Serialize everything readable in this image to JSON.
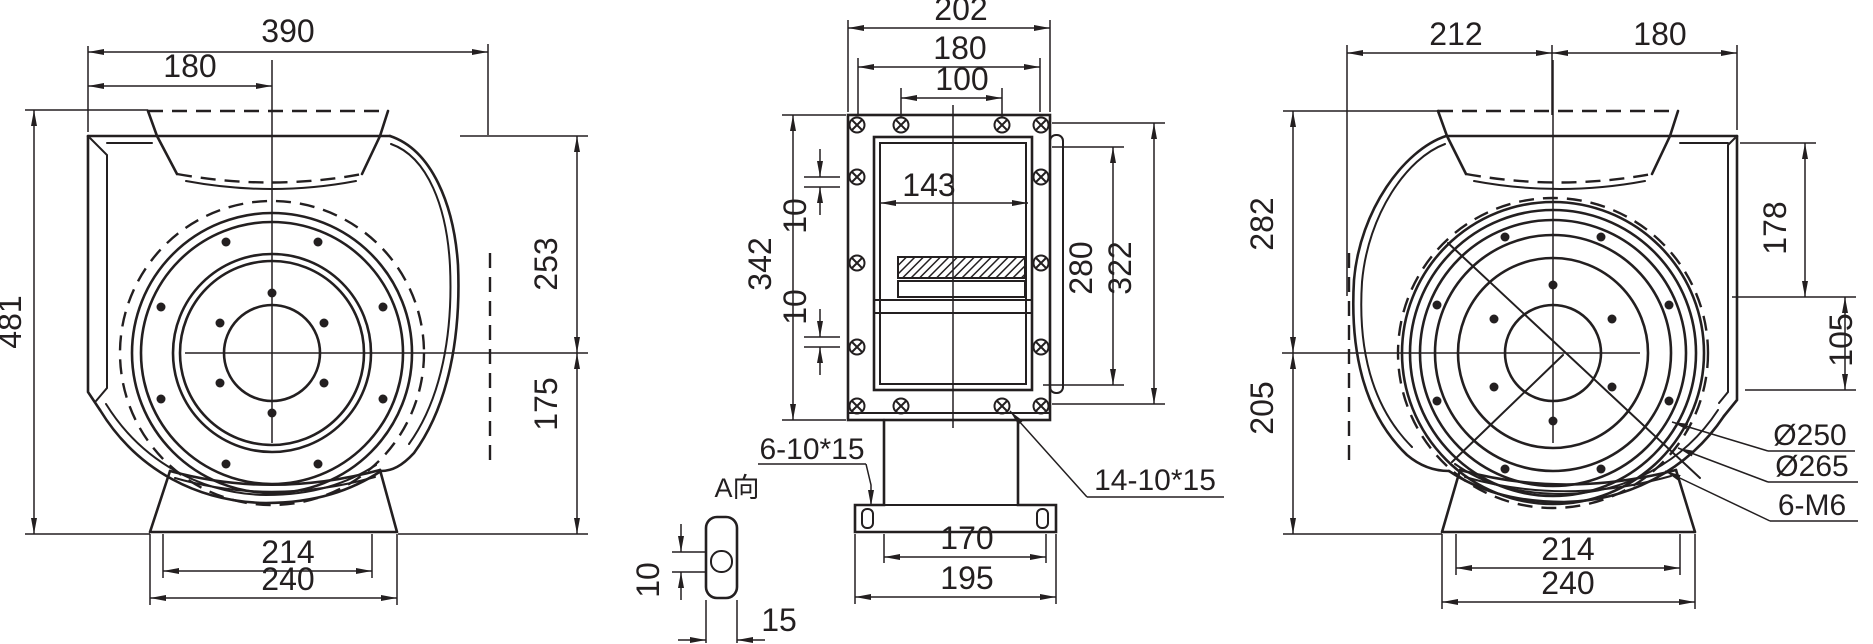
{
  "drawing": {
    "type": "technical-dimension-drawing",
    "subject": "centrifugal fan three-view dimensional drawing",
    "background": "#ffffff",
    "line_color": "#231f20",
    "views": {
      "left": {
        "name": "inlet-side-view",
        "dims": {
          "overall_width": "390",
          "inlet_offset": "180",
          "overall_height": "481",
          "upper_height": "253",
          "lower_height": "175",
          "base_holes": "214",
          "base_width": "240"
        }
      },
      "front": {
        "name": "outlet-flange-view",
        "dims": {
          "flange_width": "202",
          "bolt_span": "180",
          "bolt_pitch": "100",
          "flange_height": "342",
          "opening_width": "143",
          "gap_top": "10",
          "gap_bottom": "10",
          "bolt_height": "280",
          "outer_height": "322",
          "foot_holes": "170",
          "foot_width": "195",
          "detail_height": "10",
          "detail_width": "15"
        },
        "labels": {
          "foot_slots": "6-10*15",
          "view_a": "A向",
          "flange_slots": "14-10*15"
        }
      },
      "right": {
        "name": "motor-side-view",
        "dims": {
          "width_left": "212",
          "width_right": "180",
          "upper_height": "282",
          "lower_height": "205",
          "side_upper": "178",
          "side_lower": "105",
          "base_holes": "214",
          "base_width": "240"
        },
        "labels": {
          "bolt_circle_inner": "Ø250",
          "bolt_circle_outer": "Ø265",
          "tapped_holes": "6-M6"
        }
      }
    }
  }
}
